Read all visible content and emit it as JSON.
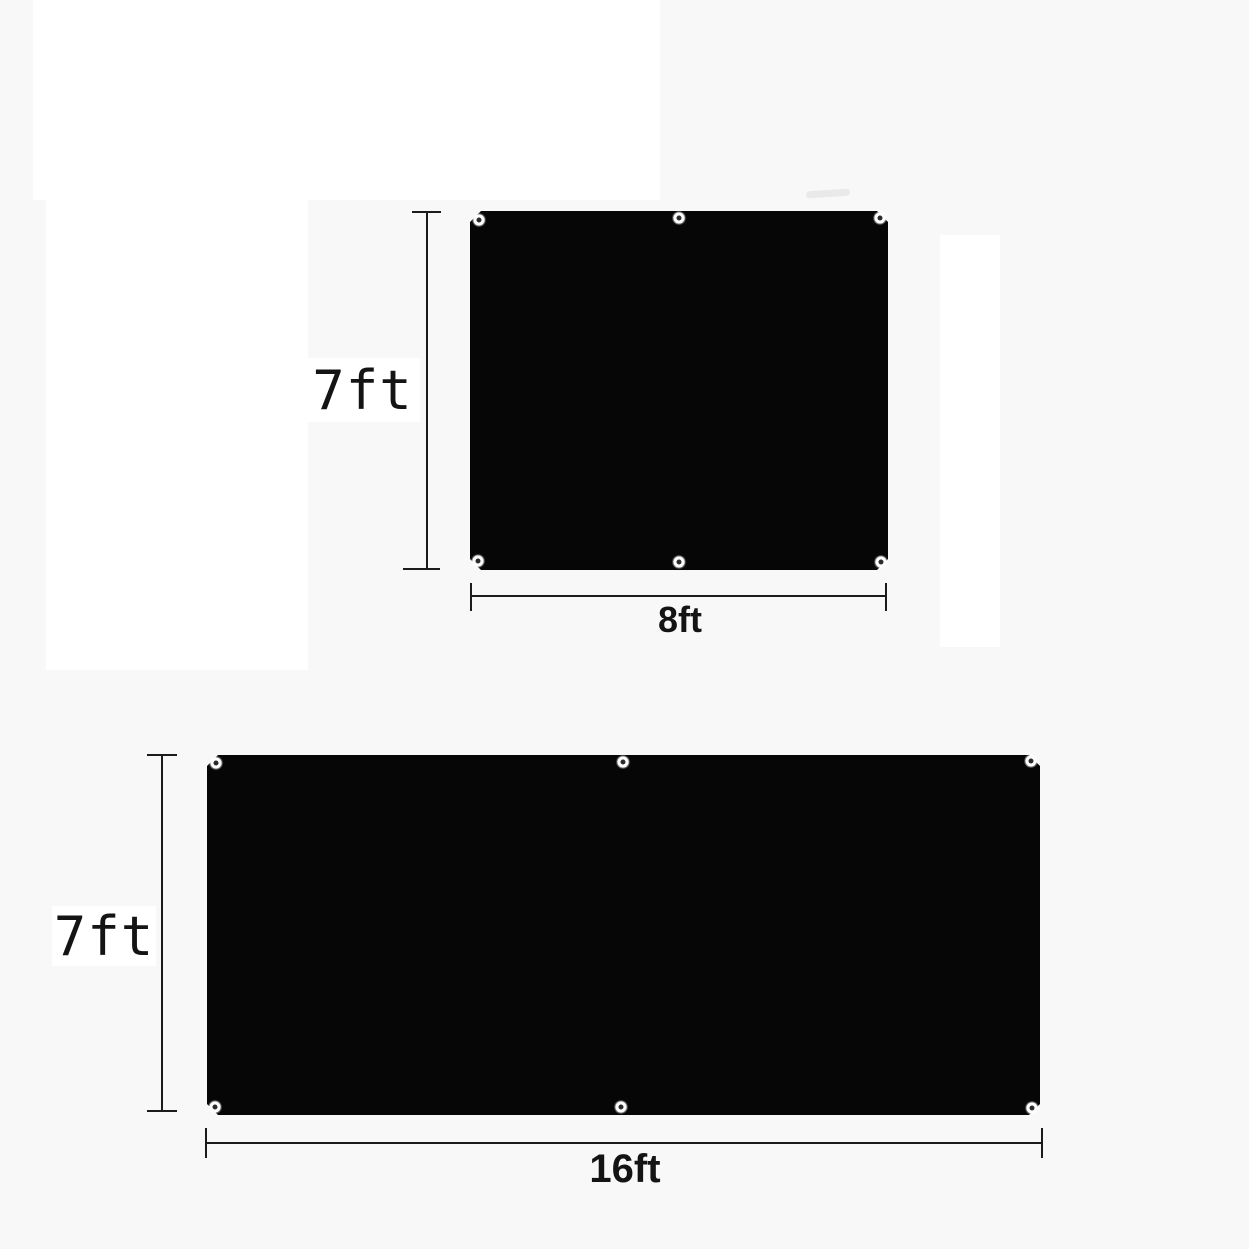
{
  "diagram": {
    "title": "tarp-dimension-diagram",
    "panels": [
      {
        "name": "panel-8ft-by-7ft",
        "height_label": "7ft",
        "width_label": "8ft",
        "grommet_count": 6
      },
      {
        "name": "panel-16ft-by-7ft",
        "height_label": "7ft",
        "width_label": "16ft",
        "grommet_count": 6
      }
    ]
  },
  "colors": {
    "background": "#f8f8f8",
    "patch_white": "#ffffff",
    "tarp_black": "#060606",
    "line": "#1b1b1b",
    "text": "#141414"
  }
}
